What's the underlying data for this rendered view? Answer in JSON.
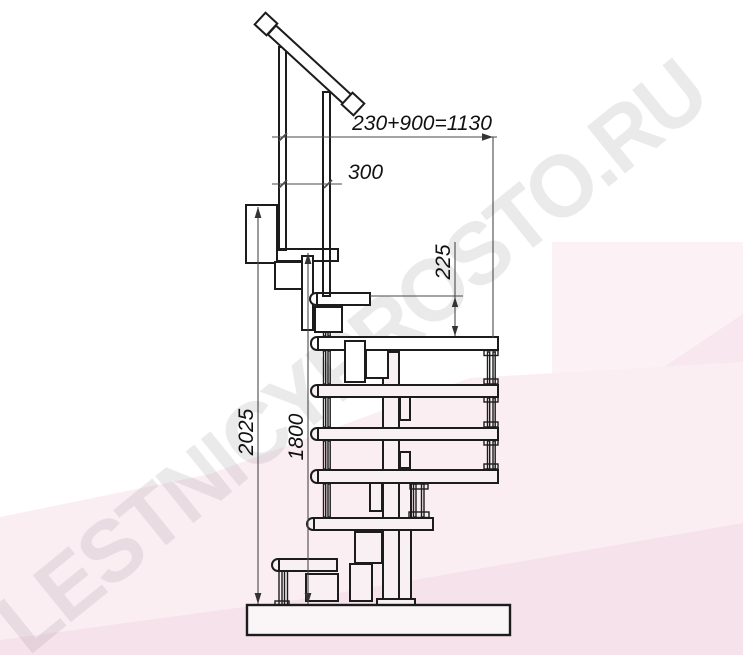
{
  "watermark": {
    "text": "LESTNICYPROSTO.RU"
  },
  "dimensions": {
    "overall_run": "230+900=1130",
    "rail_spacing": "300",
    "step_rise": "225",
    "total_height": "2025",
    "platform_height": "1800"
  },
  "colors": {
    "background": "#ffffff",
    "photo_tint_rect": "#fcf1f5",
    "photo_tint_light": "#fbeef3",
    "photo_tint_mid": "#f8e7ee",
    "photo_tint_dark": "#f6e2ea",
    "drawing_line": "#1c1c1c",
    "drawing_fill_upper": "#ffffff",
    "drawing_fill_lower": "#f9f0f4",
    "base_fill": "#faf5f7",
    "dimension_line": "#4a4a4a",
    "dimension_text": "#111111",
    "watermark_gray": "#8a8088"
  }
}
